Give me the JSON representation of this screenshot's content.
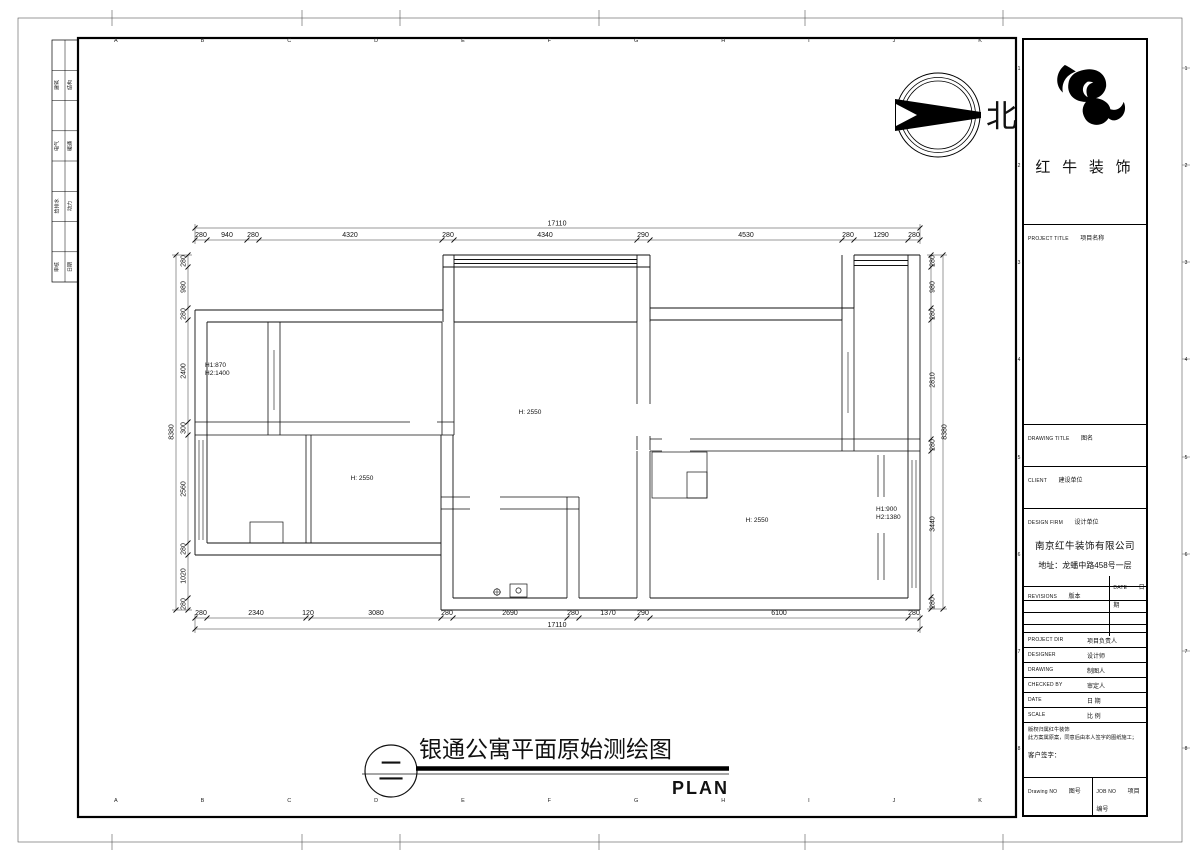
{
  "frame": {
    "letters": [
      "A",
      "B",
      "C",
      "D",
      "E",
      "F",
      "G",
      "H",
      "I",
      "J",
      "K"
    ],
    "side_numbers": [
      "1",
      "2",
      "3",
      "4",
      "5",
      "6",
      "7",
      "8"
    ]
  },
  "sign_table": {
    "rows": [
      [
        "建筑",
        "结构"
      ],
      [
        "电气",
        "暖通"
      ],
      [
        "给排水",
        "动力"
      ],
      [
        "审核",
        "日期"
      ]
    ]
  },
  "north": {
    "label": "北"
  },
  "plan": {
    "dims": {
      "top_total": "17110",
      "bottom_total": "17110",
      "left_total": "8380",
      "right_total": "8380",
      "top": [
        "280",
        "940",
        "280",
        "4320",
        "280",
        "4340",
        "290",
        "4530",
        "280",
        "1290",
        "280"
      ],
      "bottom": [
        "280",
        "2340",
        "120",
        "3080",
        "280",
        "2690",
        "280",
        "1370",
        "290",
        "6100",
        "280"
      ],
      "left": [
        "280",
        "980",
        "280",
        "2400",
        "300",
        "2560",
        "280",
        "1020",
        "280"
      ],
      "right": [
        "280",
        "980",
        "280",
        "2810",
        "280",
        "3440",
        "280"
      ]
    },
    "labels": {
      "left_window_1": "H1:870",
      "left_window_2": "H2:1400",
      "hall_height": "H: 2550",
      "room_b_height": "H: 2550",
      "room_r_height": "H: 2550",
      "right_window_1": "H1:900",
      "right_window_2": "H2:1380"
    }
  },
  "title": {
    "zh": "银通公寓平面原始测绘图",
    "en": "PLAN",
    "index": "二"
  },
  "titleblock": {
    "brand": "红 牛 装 饰",
    "project_title_en": "PROJECT TITLE",
    "project_title_zh": "项目名称",
    "drawing_title_en": "DRAWING TITLE",
    "drawing_title_zh": "图名",
    "client_en": "CLIENT",
    "client_zh": "建设单位",
    "design_firm_en": "DESIGN FIRM",
    "design_firm_zh": "设计单位",
    "company": "南京红牛装饰有限公司",
    "address": "地址：龙蟠中路458号一层",
    "revisions_en": "REVISIONS",
    "revisions_zh": "版本",
    "date_col_en": "DATE",
    "date_col_zh": "日期",
    "project_dir_en": "PROJECT DIR",
    "project_dir_zh": "项目负责人",
    "designer_en": "DESIGNER",
    "designer_zh": "设计师",
    "drawing_en": "DRAWING",
    "drawing_zh": "制图人",
    "checked_en": "CHECKED BY",
    "checked_zh": "审定人",
    "date_en": "DATE",
    "date_zh": "日 期",
    "scale_en": "SCALE",
    "scale_zh": "比 例",
    "copyright1": "版权归属红牛装饰",
    "copyright2": "此方案属原案，同意后由本人签字的图纸施工；",
    "client_sign": "客户签字：",
    "drawing_no_en": "Drawing NO",
    "drawing_no_zh": "图号",
    "job_no_en": "JOB NO",
    "job_no_zh": "项目编号"
  }
}
